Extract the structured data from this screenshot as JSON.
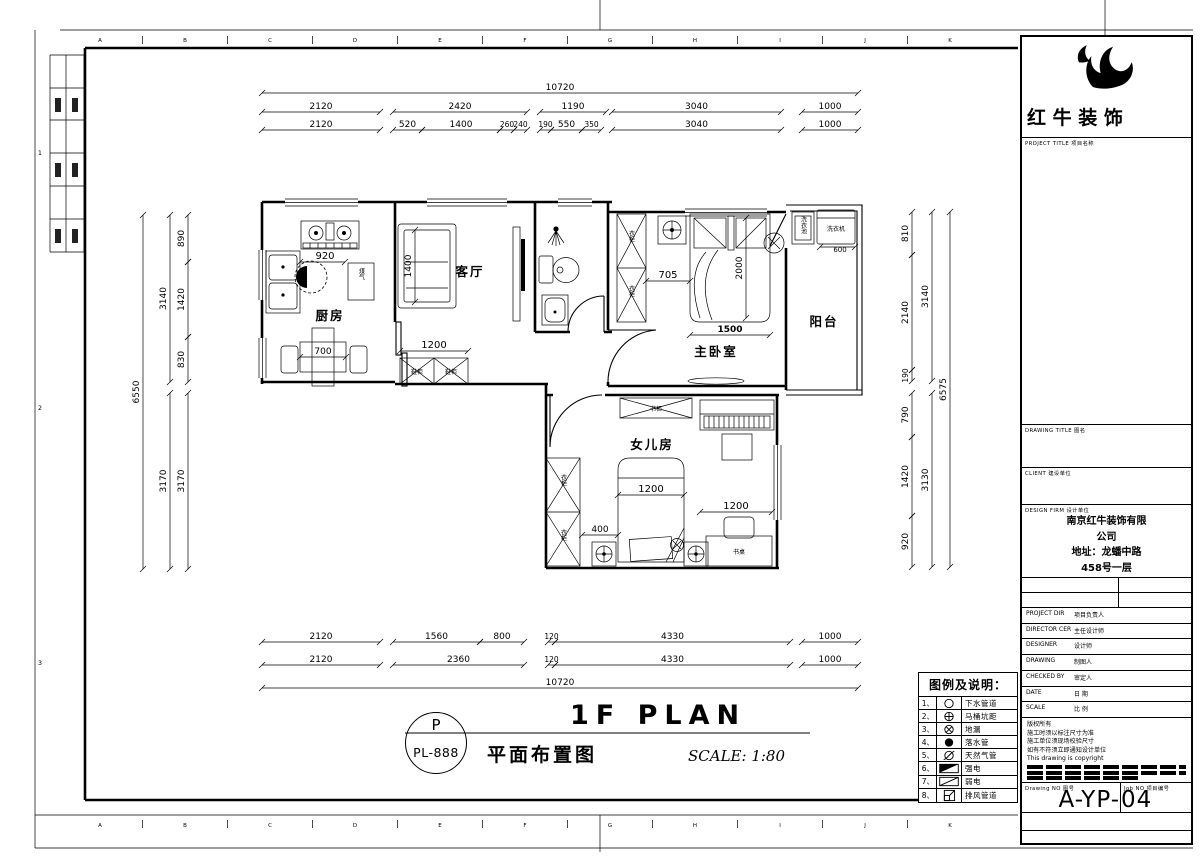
{
  "meta": {
    "sheet_title": "1F PLAN",
    "sheet_subtitle": "平面布置图",
    "scale_label": "SCALE: 1:80",
    "detail_circle_top": "P",
    "detail_circle_bottom": "PL-888"
  },
  "brand": {
    "logo_text": "红 牛 装 饰"
  },
  "title_block": {
    "project_title_label": "PROJECT TITLE  项目名称",
    "drawing_title_label": "DRAWING TITLE  图名",
    "client_label": "CLIENT  建设单位",
    "design_firm_label": "DESIGN FIRM  设计单位",
    "design_firm_value_lines": [
      "南京红牛装饰有限",
      "公司",
      "地址：龙蟠中路",
      "458号一层"
    ],
    "rows": [
      {
        "en": "PROJECT DIR",
        "zh": "项目负责人"
      },
      {
        "en": "DIRECTOR CER",
        "zh": "主任设计师"
      },
      {
        "en": "DESIGNER",
        "zh": "设计师"
      },
      {
        "en": "DRAWING",
        "zh": "制图人"
      },
      {
        "en": "CHECKED BY",
        "zh": "审定人"
      },
      {
        "en": "DATE",
        "zh": "日 期"
      },
      {
        "en": "SCALE",
        "zh": "比 例"
      }
    ],
    "copyright_lines": [
      "版权所有",
      "施工时须以标注尺寸为准",
      "施工单位须现场校验尺寸",
      "如有不符须立即通知设计单位",
      "This drawing is copyright"
    ],
    "drawing_no_label": "Drawing NO  图号",
    "job_no_label": "Job NO  项目编号",
    "drawing_no_value": "A-YP-",
    "job_no_value": "04"
  },
  "legend": {
    "title": "图例及说明：",
    "items": [
      {
        "num": "1、",
        "symbol": "circle-open",
        "label": "下水管道"
      },
      {
        "num": "2、",
        "symbol": "circle-cross",
        "label": "马桶坑距"
      },
      {
        "num": "3、",
        "symbol": "circle-x",
        "label": "地漏"
      },
      {
        "num": "4、",
        "symbol": "circle-filled",
        "label": "落水管"
      },
      {
        "num": "5、",
        "symbol": "circle-slash",
        "label": "天然气管"
      },
      {
        "num": "6、",
        "symbol": "rect-diagonal-filled",
        "label": "强电"
      },
      {
        "num": "7、",
        "symbol": "rect-diagonal",
        "label": "弱电"
      },
      {
        "num": "8、",
        "symbol": "square-corner",
        "label": "排风管道"
      }
    ]
  },
  "rooms": {
    "kitchen": "厨房",
    "living": "客厅",
    "master": "主卧室",
    "balcony": "阳台",
    "daughter": "女儿房"
  },
  "furniture": {
    "gas": "煤气",
    "wardrobe": "衣柜",
    "bookcase": "书柜",
    "desk": "书桌",
    "laundry_sink": "洗衣池",
    "washer": "洗衣机",
    "shoe_cab": "鞋柜"
  },
  "dims": {
    "top1": "10720",
    "top2": [
      "2120",
      "2420",
      "1190",
      "3040",
      "1000"
    ],
    "top3": [
      "2120",
      "520",
      "1400",
      "260",
      "240",
      "190",
      "550",
      "350",
      "3040",
      "1000"
    ],
    "bottom1": [
      "2120",
      "1560",
      "800",
      "120",
      "4330",
      "1000"
    ],
    "bottom2": [
      "2120",
      "2360",
      "120",
      "4330",
      "1000"
    ],
    "bottom3": "10720",
    "left_outer": "6550",
    "left_mid": [
      "3140",
      "3170"
    ],
    "left_inner": [
      "890",
      "1420",
      "830",
      "3170"
    ],
    "right_inner": [
      "810",
      "2140",
      "190",
      "790",
      "1420",
      "920"
    ],
    "right_mid": [
      "3140",
      "3130"
    ],
    "right_outer": "6575",
    "plan": {
      "kitchen_sink": "920",
      "kitchen_table": "700",
      "sofa": "1400",
      "shoe": "1200",
      "bed_gap": "705",
      "bed_w": "1500",
      "bed_l": "2000",
      "washer": "600",
      "girl_bed": "1200",
      "girl_gap": "400",
      "desk": "1200"
    }
  },
  "frame": {
    "grid_letters": [
      "A",
      "B",
      "C",
      "D",
      "E",
      "F",
      "G",
      "H",
      "I",
      "J",
      "K"
    ],
    "row_numbers": [
      "1",
      "2",
      "3"
    ]
  }
}
